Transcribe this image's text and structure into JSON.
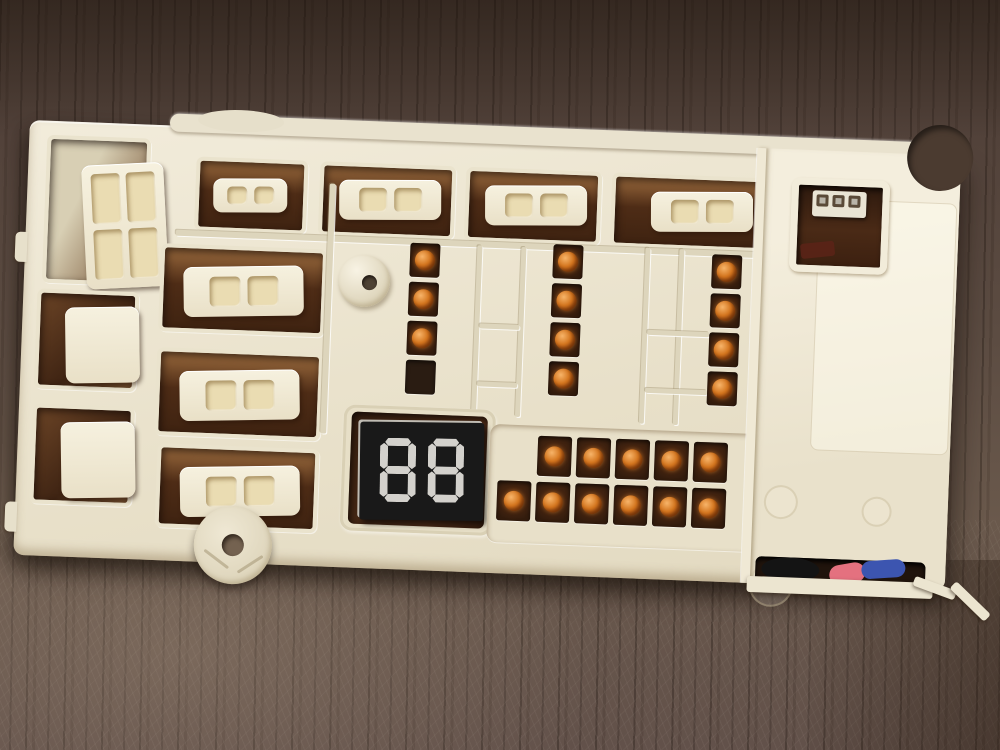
{
  "board": {
    "display": {
      "digits": [
        "8",
        "8"
      ]
    },
    "led_strips": [
      {
        "id": "strip-left",
        "leds": [
          true,
          true,
          true,
          false
        ]
      },
      {
        "id": "strip-middle",
        "leds": [
          true,
          true,
          true,
          true
        ]
      },
      {
        "id": "strip-right",
        "leds": [
          true,
          true,
          true,
          true
        ]
      }
    ],
    "led_grid": {
      "rows": [
        {
          "cells": 5,
          "indent": 1
        },
        {
          "cells": 6,
          "indent": 0
        }
      ]
    },
    "connectors": {
      "top_row_two_pin": 4,
      "left_column_four_pin": 3,
      "middle_column_two_pin": 3,
      "small_two_pin_near_display": 1,
      "window_header_pins": 3
    },
    "wires": [
      "black",
      "pink",
      "blue"
    ]
  },
  "colors": {
    "board_plastic": "#efe8d4",
    "recess_brown": "#4a2a15",
    "led_orange": "#d4761f",
    "display_black": "#191919",
    "display_segment": "#d3d1cc",
    "wood_dark": "#4b3b30",
    "wood_light": "#74634f",
    "wire_pink": "#e4717f",
    "wire_blue": "#3c55b0",
    "wire_black": "#141414"
  }
}
